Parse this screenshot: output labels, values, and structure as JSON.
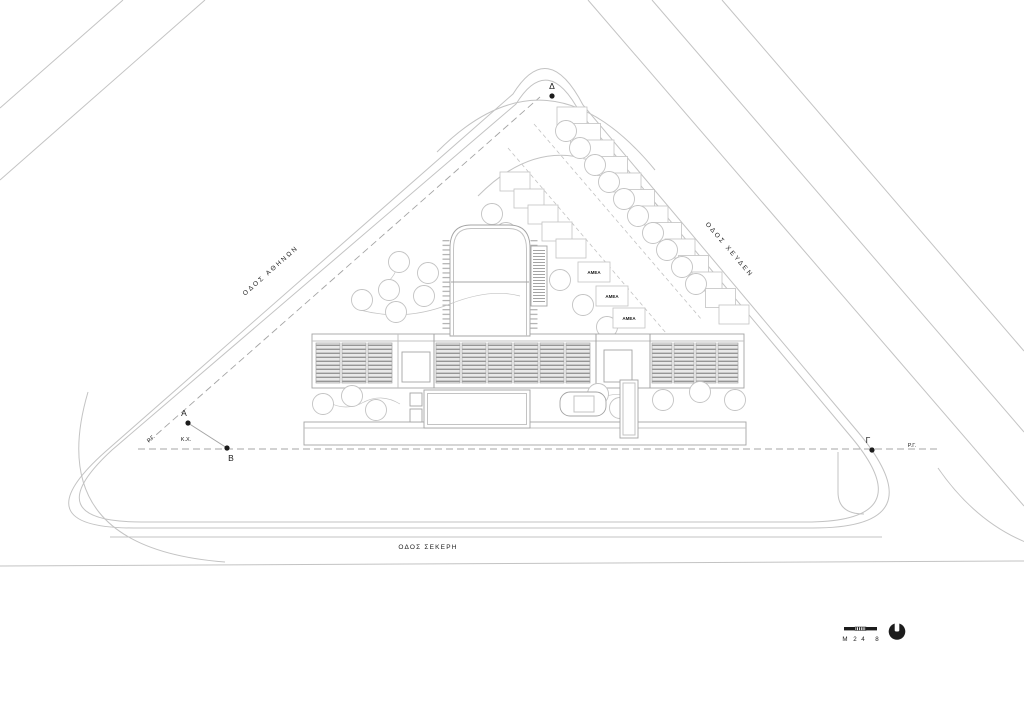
{
  "streets": {
    "left": "ΟΔΟΣ ΑΘΗΝΩΝ",
    "right": "ΟΔΟΣ ΧΕΥΔΕΝ",
    "bottom": "ΟΔΟΣ ΣΕΚΕΡΗ"
  },
  "survey_points": {
    "alpha": "Α",
    "beta": "Β",
    "gamma": "Γ",
    "delta": "Δ"
  },
  "boundary_labels": {
    "rg_left": "Ρ.Γ.",
    "rg_right": "Ρ.Γ.",
    "public_space": "Κ.Χ."
  },
  "parking": {
    "accessible_stalls": [
      "ΑΜΕΑ",
      "ΑΜΕΑ",
      "ΑΜΕΑ"
    ]
  },
  "scale_bar": {
    "unit_label": "Μ",
    "tick_labels": [
      "2",
      "4",
      "8"
    ]
  },
  "icons": {
    "north_indicator_icon": "filled-disc-with-top-notch"
  },
  "colors": {
    "line_light": "#c3c3c3",
    "line_mid": "#a4a4a4",
    "ink": "#1c1c1c",
    "panel_fill": "#e9e9e9",
    "panel_stripe": "#969696"
  }
}
